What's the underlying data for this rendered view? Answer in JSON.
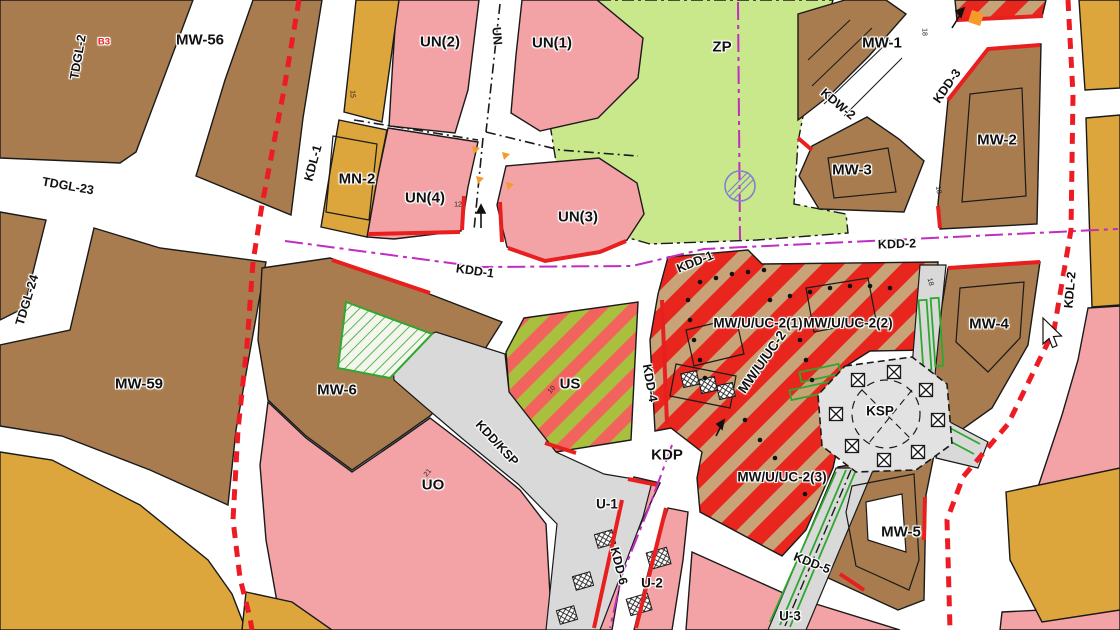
{
  "map": {
    "title": "zoning-plan-map",
    "palette": {
      "white": "#ffffff",
      "black": "#1a1a1a",
      "brown": "#a87c4e",
      "pink": "#f3a2a6",
      "mustard": "#dda63c",
      "zp_green": "#c9e88c",
      "us_green": "#a9bf3e",
      "us_red": "#f2635d",
      "stripe_red": "#e8261d",
      "stripe_tan": "#c7a377",
      "road_gray": "#d9d9d9",
      "ksp_gray": "#e2e2e2",
      "magenta": "#c12cc1",
      "red_line": "#e81f1f",
      "boundary_red": "#ed1c24",
      "green_line": "#2ea82e",
      "orange_mark": "#f59b2c",
      "symbol_blue": "#8080cf"
    },
    "labels": [
      {
        "text": "TDGL-2",
        "x": 78,
        "y": 57,
        "rot": -80,
        "cls": "lab-road"
      },
      {
        "text": "B3",
        "x": 104,
        "y": 42,
        "rot": 0,
        "cls": "lab-small",
        "color": "#e81f1f"
      },
      {
        "text": "MW-56",
        "x": 200,
        "y": 40,
        "rot": 0,
        "cls": "lab-zone"
      },
      {
        "text": "UN(2)",
        "x": 440,
        "y": 42,
        "rot": 0,
        "cls": "lab-zone"
      },
      {
        "text": "UN",
        "x": 497,
        "y": 36,
        "rot": 85,
        "cls": "lab-road"
      },
      {
        "text": "UN(1)",
        "x": 552,
        "y": 43,
        "rot": 0,
        "cls": "lab-zone"
      },
      {
        "text": "ZP",
        "x": 722,
        "y": 47,
        "rot": 0,
        "cls": "lab-zone"
      },
      {
        "text": "MW-1",
        "x": 882,
        "y": 43,
        "rot": 0,
        "cls": "lab-zone"
      },
      {
        "text": "KDW-2",
        "x": 838,
        "y": 104,
        "rot": 40,
        "cls": "lab-road"
      },
      {
        "text": "KDD-3",
        "x": 947,
        "y": 86,
        "rot": -55,
        "cls": "lab-road"
      },
      {
        "text": "MW-2",
        "x": 997,
        "y": 140,
        "rot": 0,
        "cls": "lab-zone"
      },
      {
        "text": "KDL-1",
        "x": 313,
        "y": 163,
        "rot": -75,
        "cls": "lab-road"
      },
      {
        "text": "MN-2",
        "x": 357,
        "y": 179,
        "rot": 0,
        "cls": "lab-zone"
      },
      {
        "text": "TDGL-23",
        "x": 68,
        "y": 186,
        "rot": 10,
        "cls": "lab-road"
      },
      {
        "text": "UN(4)",
        "x": 425,
        "y": 198,
        "rot": 0,
        "cls": "lab-zone"
      },
      {
        "text": "UN(3)",
        "x": 578,
        "y": 217,
        "rot": 0,
        "cls": "lab-zone"
      },
      {
        "text": "MW-3",
        "x": 852,
        "y": 170,
        "rot": 0,
        "cls": "lab-zone"
      },
      {
        "text": "TDGL-24",
        "x": 27,
        "y": 300,
        "rot": -73,
        "cls": "lab-road"
      },
      {
        "text": "KDD-1",
        "x": 475,
        "y": 271,
        "rot": 8,
        "cls": "lab-road"
      },
      {
        "text": "KDD-1",
        "x": 695,
        "y": 262,
        "rot": -22,
        "cls": "lab-road"
      },
      {
        "text": "KDD-2",
        "x": 897,
        "y": 244,
        "rot": -2,
        "cls": "lab-road"
      },
      {
        "text": "KDL-2",
        "x": 1070,
        "y": 290,
        "rot": -85,
        "cls": "lab-road"
      },
      {
        "text": "MW/U/UC-2(1)",
        "x": 758,
        "y": 323,
        "rot": 0,
        "cls": "lab-zonesm"
      },
      {
        "text": "MW/U/UC-2(2)",
        "x": 848,
        "y": 323,
        "rot": 0,
        "cls": "lab-zonesm"
      },
      {
        "text": "MW-4",
        "x": 989,
        "y": 324,
        "rot": 0,
        "cls": "lab-zone"
      },
      {
        "text": "MW/U/UC-2",
        "x": 762,
        "y": 362,
        "rot": -55,
        "cls": "lab-zonesm"
      },
      {
        "text": "MW-6",
        "x": 337,
        "y": 390,
        "rot": 0,
        "cls": "lab-zone"
      },
      {
        "text": "US",
        "x": 570,
        "y": 384,
        "rot": 0,
        "cls": "lab-zone"
      },
      {
        "text": "KDD-4",
        "x": 650,
        "y": 383,
        "rot": 80,
        "cls": "lab-road"
      },
      {
        "text": "MW-59",
        "x": 139,
        "y": 384,
        "rot": 0,
        "cls": "lab-zone"
      },
      {
        "text": "KSP",
        "x": 880,
        "y": 411,
        "rot": 0,
        "cls": "lab-zonesm"
      },
      {
        "text": "KDD/KSP",
        "x": 497,
        "y": 443,
        "rot": 47,
        "cls": "lab-road"
      },
      {
        "text": "KDP",
        "x": 667,
        "y": 455,
        "rot": 0,
        "cls": "lab-zone"
      },
      {
        "text": "UO",
        "x": 433,
        "y": 485,
        "rot": 0,
        "cls": "lab-zone"
      },
      {
        "text": "MW/U/UC-2(3)",
        "x": 782,
        "y": 477,
        "rot": 0,
        "cls": "lab-zonesm"
      },
      {
        "text": "U-1",
        "x": 607,
        "y": 504,
        "rot": 0,
        "cls": "lab-zonesm"
      },
      {
        "text": "MW-5",
        "x": 901,
        "y": 532,
        "rot": 0,
        "cls": "lab-zone"
      },
      {
        "text": "KDD-5",
        "x": 812,
        "y": 563,
        "rot": 21,
        "cls": "lab-road"
      },
      {
        "text": "KDD-6",
        "x": 619,
        "y": 566,
        "rot": 76,
        "cls": "lab-road"
      },
      {
        "text": "U-2",
        "x": 652,
        "y": 583,
        "rot": 0,
        "cls": "lab-zonesm"
      },
      {
        "text": "U-3",
        "x": 790,
        "y": 616,
        "rot": 0,
        "cls": "lab-zonesm"
      }
    ],
    "dimension_labels": [
      {
        "text": "15",
        "x": 352,
        "y": 94,
        "rot": 90,
        "cls": "lab-dim"
      },
      {
        "text": "12",
        "x": 458,
        "y": 205,
        "rot": 0,
        "cls": "lab-dim"
      },
      {
        "text": "18",
        "x": 924,
        "y": 32,
        "rot": 90,
        "cls": "lab-dim"
      },
      {
        "text": "18",
        "x": 938,
        "y": 190,
        "rot": 80,
        "cls": "lab-dim"
      },
      {
        "text": "18",
        "x": 930,
        "y": 282,
        "rot": 75,
        "cls": "lab-dim"
      },
      {
        "text": "21",
        "x": 428,
        "y": 473,
        "rot": -50,
        "cls": "lab-dim"
      },
      {
        "text": "10",
        "x": 552,
        "y": 390,
        "rot": -50,
        "cls": "lab-dim"
      }
    ]
  }
}
